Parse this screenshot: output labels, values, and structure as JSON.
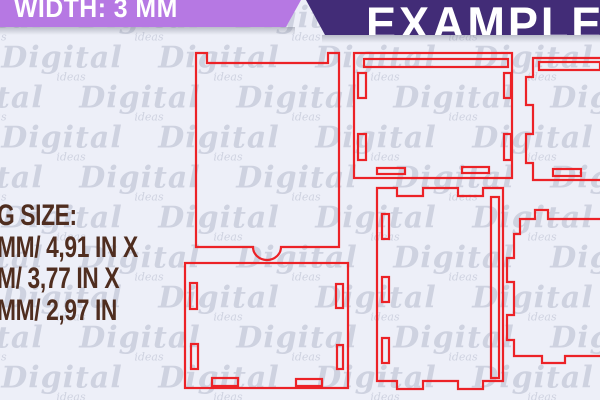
{
  "header": {
    "width_label": "WIDTH: 3 MM",
    "example_label": "EXAMPLE"
  },
  "size_info": {
    "lines": [
      "G SIZE:",
      "MM/ 4,91 IN X",
      "M/ 3,77 IN X",
      "MM/ 2,97 IN"
    ]
  },
  "watermark": {
    "text": "Digital",
    "subtext": "ideas"
  },
  "template": {
    "pieces": [
      "front-lid-panel-with-thumb-tab",
      "base-panel-with-slots",
      "back-panel-with-slots",
      "right-panel-cropped",
      "side-panel-with-finger-joints",
      "bottom-right-panel-cropped"
    ]
  },
  "colors": {
    "background": "#edeff8",
    "banner_light_purple": "#b678e3",
    "banner_dark_purple": "#422c77",
    "cut_line_red": "#ec2227",
    "size_text_brown": "#4f2d1f",
    "watermark_gray": "#959cb3"
  }
}
